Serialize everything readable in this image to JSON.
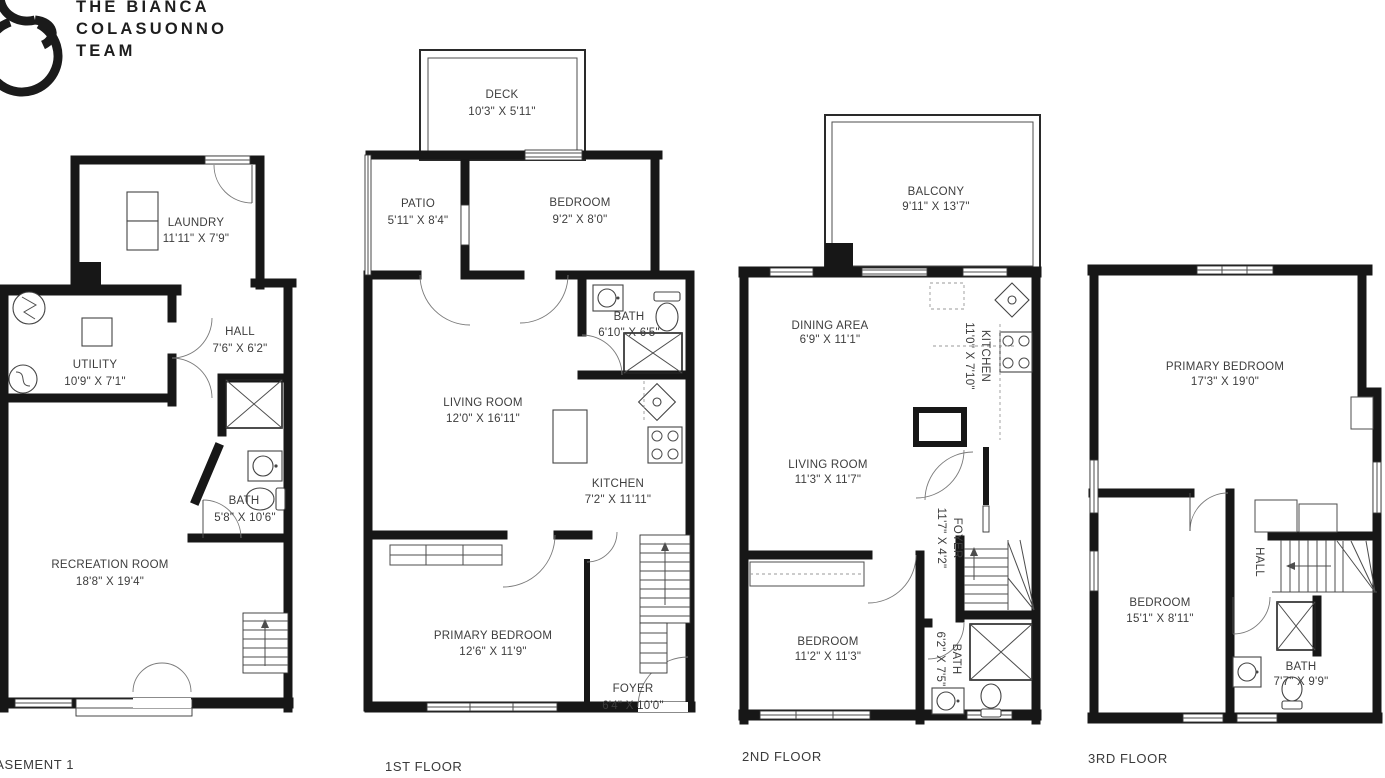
{
  "logo": {
    "line1": "THE BIANCA",
    "line2": "COLASUONNO",
    "line3": "TEAM"
  },
  "floors": {
    "basement": {
      "label": "BASEMENT 1",
      "rooms": {
        "laundry": {
          "name": "LAUNDRY",
          "dims": "11'11\" X 7'9\""
        },
        "utility": {
          "name": "UTILITY",
          "dims": "10'9\" X 7'1\""
        },
        "hall": {
          "name": "HALL",
          "dims": "7'6\" X 6'2\""
        },
        "bath": {
          "name": "BATH",
          "dims": "5'8\" X 10'6\""
        },
        "recreation": {
          "name": "RECREATION ROOM",
          "dims": "18'8\" X 19'4\""
        }
      }
    },
    "first": {
      "label": "1ST FLOOR",
      "rooms": {
        "deck": {
          "name": "DECK",
          "dims": "10'3\" X 5'11\""
        },
        "patio": {
          "name": "PATIO",
          "dims": "5'11\" X 8'4\""
        },
        "bedroom": {
          "name": "BEDROOM",
          "dims": "9'2\" X 8'0\""
        },
        "bath": {
          "name": "BATH",
          "dims": "6'10\" X 6'5\""
        },
        "living": {
          "name": "LIVING ROOM",
          "dims": "12'0\" X 16'11\""
        },
        "kitchen": {
          "name": "KITCHEN",
          "dims": "7'2\" X 11'11\""
        },
        "primary": {
          "name": "PRIMARY BEDROOM",
          "dims": "12'6\" X 11'9\""
        },
        "foyer": {
          "name": "FOYER",
          "dims": "6'4\" X 10'0\""
        }
      }
    },
    "second": {
      "label": "2ND FLOOR",
      "rooms": {
        "balcony": {
          "name": "BALCONY",
          "dims": "9'11\" X 13'7\""
        },
        "dining": {
          "name": "DINING AREA",
          "dims": "6'9\" X 11'1\""
        },
        "kitchen": {
          "name": "KITCHEN",
          "dims": "11'0\" X 7'10\""
        },
        "living": {
          "name": "LIVING ROOM",
          "dims": "11'3\" X 11'7\""
        },
        "foyer": {
          "name": "FOYER",
          "dims": "11'7\" X 4'2\""
        },
        "bedroom": {
          "name": "BEDROOM",
          "dims": "11'2\" X 11'3\""
        },
        "bath": {
          "name": "BATH",
          "dims": "6'2\" X 7'5\""
        }
      }
    },
    "third": {
      "label": "3RD FLOOR",
      "rooms": {
        "primary": {
          "name": "PRIMARY BEDROOM",
          "dims": "17'3\" X 19'0\""
        },
        "bedroom": {
          "name": "BEDROOM",
          "dims": "15'1\" X 8'11\""
        },
        "hall": {
          "name": "HALL"
        },
        "bath": {
          "name": "BATH",
          "dims": "7'7\" X 9'9\""
        }
      }
    }
  }
}
